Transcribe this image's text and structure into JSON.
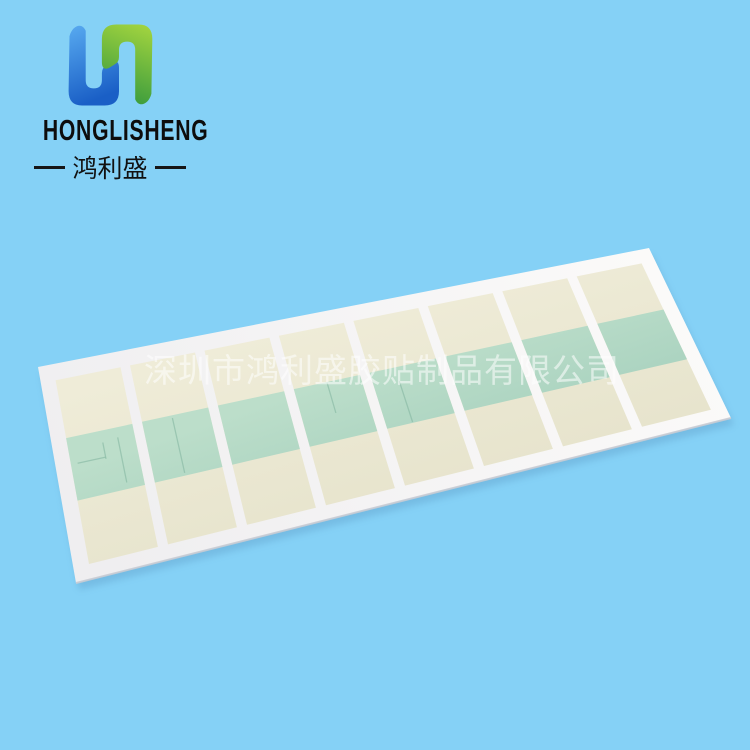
{
  "page": {
    "width": 750,
    "height": 750,
    "background_color": "#85d1f6"
  },
  "brand": {
    "name_en": "HONGLISHENG",
    "name_cn": "鸿利盛",
    "logo_colors": {
      "blue_top": "#58aaf0",
      "blue_bottom": "#1a5fc6",
      "green_top": "#a6d63f",
      "green_bottom": "#3f9e3d"
    }
  },
  "watermark": {
    "text": "深圳市鸿利盛胶贴制品有限公司",
    "color": "#ffffff",
    "opacity": 0.55
  },
  "product": {
    "kind": "die-cut adhesive sticker sheet photo",
    "sticker_count": 8,
    "colors": {
      "sheet_light": "#fbfaf9",
      "sheet_dark": "#efeef0",
      "sticker_light": "#efecd8",
      "sticker_dark": "#e7e4cd",
      "band_light": "#bcdeca",
      "band_dark": "#a9d2bf",
      "edge": "#c9ccd4",
      "shadow": "#4f87b5",
      "cut_line": "#85b7a2"
    },
    "geometry": {
      "corners": {
        "tl": [
          38,
          367
        ],
        "tr": [
          649,
          248
        ],
        "br": [
          731,
          418
        ],
        "bl": [
          76,
          583
        ]
      },
      "margin_left": 0.024,
      "margin_right": 0.022,
      "margin_top": 0.075,
      "margin_bottom": 0.07,
      "gap": 0.0155,
      "band_v": [
        0.315,
        0.655
      ],
      "cut_marks": [
        {
          "s": 0,
          "kind": "h",
          "u": [
            0.1,
            0.52
          ],
          "v": 0.46
        },
        {
          "s": 0,
          "kind": "v",
          "u": 0.52,
          "v": [
            0.38,
            0.47
          ]
        },
        {
          "s": 0,
          "kind": "v",
          "u": 0.75,
          "v": [
            0.37,
            0.62
          ]
        },
        {
          "s": 1,
          "kind": "v",
          "u": 0.45,
          "v": [
            0.33,
            0.64
          ]
        },
        {
          "s": 3,
          "kind": "v",
          "u": 0.5,
          "v": [
            0.32,
            0.5
          ]
        },
        {
          "s": 4,
          "kind": "v",
          "u": 0.38,
          "v": [
            0.4,
            0.65
          ]
        }
      ]
    }
  }
}
